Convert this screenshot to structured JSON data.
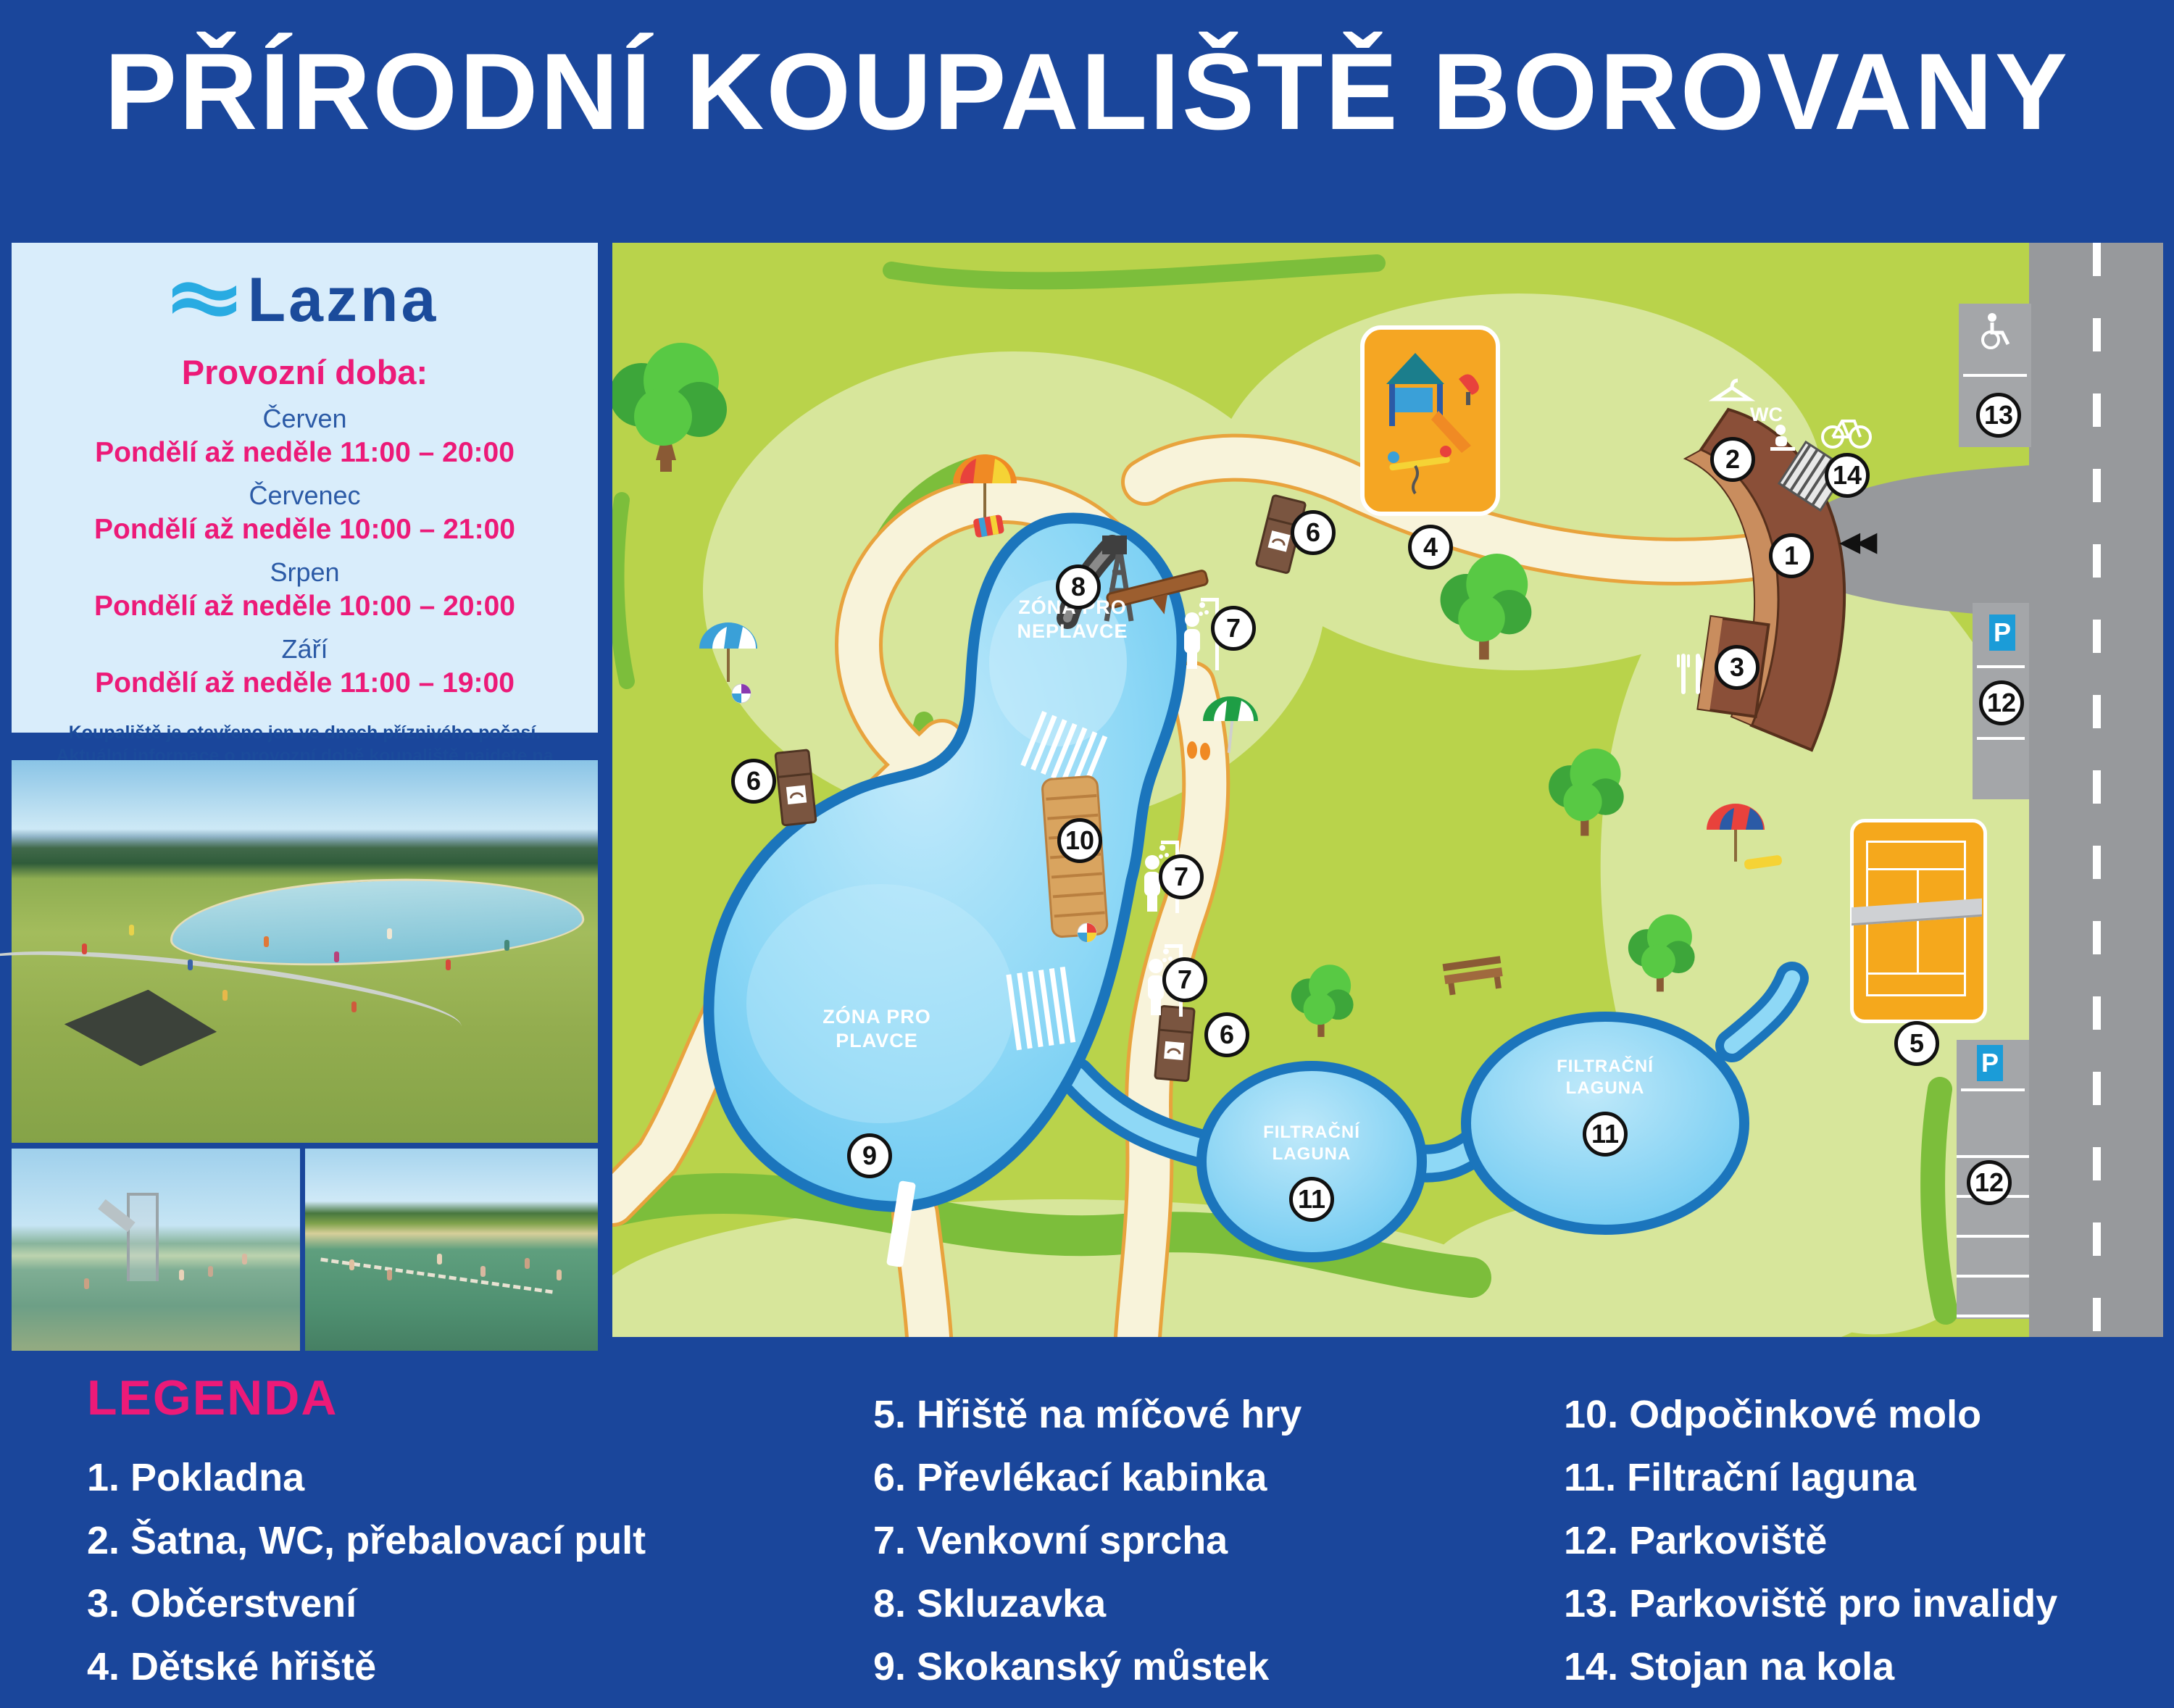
{
  "title": "PŘÍRODNÍ KOUPALIŠTĚ BOROVANY",
  "info_panel": {
    "logo_text": "Lazna",
    "heading": "Provozní doba:",
    "schedule": [
      {
        "month": "Červen",
        "hours": "Pondělí až neděle  11:00 – 20:00"
      },
      {
        "month": "Červenec",
        "hours": "Pondělí až neděle  10:00 – 21:00"
      },
      {
        "month": "Srpen",
        "hours": "Pondělí až neděle  10:00 – 20:00"
      },
      {
        "month": "Září",
        "hours": "Pondělí až neděle  11:00 – 19:00"
      }
    ],
    "note_line1": "Koupaliště je otevřeno jen ve dnech příznivého počasí.",
    "note_line2": "Aktuální informace o provozní době koupaliště najdete na webových stránkách",
    "note_line3_pre": "Města Borovany (",
    "note_link": "www.borovany-cb.cz",
    "note_line3_post": ") v sekci „Přírodní koupaliště Lazna“"
  },
  "map": {
    "zone_nonswimmers_line1": "ZÓNA PRO",
    "zone_nonswimmers_line2": "NEPLAVCE",
    "zone_swimmers_line1": "ZÓNA PRO",
    "zone_swimmers_line2": "PLAVCE",
    "lagoon_line1": "FILTRAČNÍ",
    "lagoon_line2": "LAGUNA",
    "wc_label": "WC",
    "parking_sign": "P",
    "entrance_arrows": "◀◀",
    "markers": {
      "m1": "1",
      "m2": "2",
      "m3": "3",
      "m4": "4",
      "m5": "5",
      "m6": "6",
      "m7": "7",
      "m8": "8",
      "m9": "9",
      "m10": "10",
      "m11": "11",
      "m12": "12",
      "m13": "13",
      "m14": "14"
    }
  },
  "legend": {
    "heading": "LEGENDA",
    "col1": [
      "1. Pokladna",
      "2. Šatna, WC, přebalovací pult",
      "3. Občerstvení",
      "4. Dětské hřiště"
    ],
    "col2": [
      "5. Hřiště na míčové hry",
      "6. Převlékací kabinka",
      "7. Venkovní sprcha",
      "8. Skluzavka",
      "9. Skokanský můstek"
    ],
    "col3": [
      "10. Odpočinkové molo",
      "11. Filtrační laguna",
      "12. Parkoviště",
      "13. Parkoviště pro invalidy",
      "14. Stojan na kola"
    ]
  },
  "colors": {
    "accent_pink": "#EC1A78",
    "brand_blue": "#1B4B9B",
    "cyan": "#29ABE2",
    "page_blue": "#1A469B",
    "pool_blue": "#1B75BC"
  }
}
